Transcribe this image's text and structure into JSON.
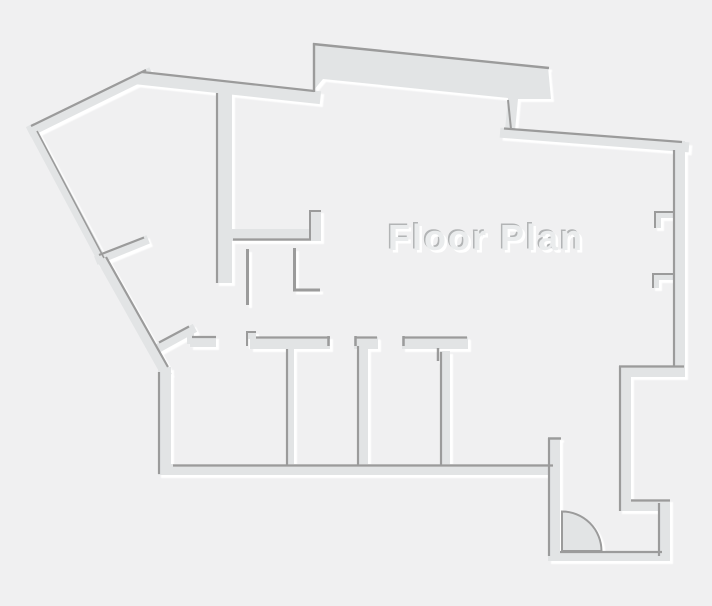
{
  "title": "Floor Plan",
  "canvas": {
    "width": 712,
    "height": 606
  },
  "colors": {
    "background": "#f0f0f1",
    "wall_fill": "#e2e4e5",
    "wall_edge": "#9b9b9b",
    "highlight": "#ffffff",
    "title_fill": "#eaeced",
    "title_shadow_dark": "#b2b4b5",
    "title_shadow_light": "#ffffff"
  },
  "floorplan": {
    "polygon_walls": [
      {
        "name": "top-protrusion-wall",
        "pts": [
          [
            313,
            91
          ],
          [
            314,
            43
          ],
          [
            548,
            67
          ],
          [
            551,
            99
          ],
          [
            518,
            99
          ],
          [
            515,
            131
          ],
          [
            505,
            130
          ],
          [
            508,
            98
          ],
          [
            323,
            79
          ]
        ]
      }
    ],
    "line_walls": [
      {
        "name": "northwest-diagonal-wall",
        "p": [
          33,
          130,
          147,
          74
        ],
        "w": 10
      },
      {
        "name": "west-upper-diagonal-wall",
        "p": [
          32,
          129,
          102,
          260
        ],
        "w": 9
      },
      {
        "name": "southwest-diagonal-wall",
        "p": [
          101,
          258,
          165,
          372
        ],
        "w": 10
      },
      {
        "name": "spur-partition-wall",
        "p": [
          100,
          259,
          144,
          241
        ],
        "w": 9
      },
      {
        "name": "top-wall",
        "p": [
          143,
          78.5,
          314,
          97
        ],
        "w": 13
      },
      {
        "name": "topright-sloped-wall",
        "p": [
          505,
          133,
          684,
          147
        ],
        "w": 10
      },
      {
        "name": "room1-diagonal-stub-wall",
        "p": [
          162,
          346,
          191,
          330
        ],
        "w": 9
      }
    ],
    "rect_walls": [
      {
        "name": "interior-vertical-wall-a",
        "r": [
          216,
          88,
          16,
          195
        ]
      },
      {
        "name": "interior-horizontal-wall-b",
        "r": [
          232,
          229,
          79,
          12
        ]
      },
      {
        "name": "interior-stub-wall-c",
        "r": [
          309,
          210,
          12,
          31
        ]
      },
      {
        "name": "right-outer-wall",
        "r": [
          673,
          141,
          12,
          236
        ]
      },
      {
        "name": "right-wall-jamb1-top",
        "r": [
          654,
          211,
          21,
          7
        ]
      },
      {
        "name": "right-wall-jamb1-side",
        "r": [
          654,
          211,
          7,
          17
        ]
      },
      {
        "name": "right-wall-jamb2-top",
        "r": [
          652,
          273,
          22,
          7
        ]
      },
      {
        "name": "right-wall-jamb2-side",
        "r": [
          652,
          273,
          7,
          15
        ]
      },
      {
        "name": "right-jog-wall",
        "r": [
          619,
          365,
          65,
          12
        ]
      },
      {
        "name": "right-lower-vertical-wall",
        "r": [
          619,
          365,
          12,
          146
        ]
      },
      {
        "name": "entry-step-wall",
        "r": [
          619,
          499,
          51,
          12
        ]
      },
      {
        "name": "entry-right-wall",
        "r": [
          658,
          499,
          12,
          62
        ]
      },
      {
        "name": "entry-bottom-wall",
        "r": [
          548,
          551,
          122,
          10
        ]
      },
      {
        "name": "entry-left-wall",
        "r": [
          548,
          437,
          12,
          124
        ]
      },
      {
        "name": "rooms-bottom-wall",
        "r": [
          158,
          464,
          395,
          11
        ]
      },
      {
        "name": "rooms-left-wall",
        "r": [
          158,
          367,
          13,
          108
        ]
      },
      {
        "name": "room1-top-wall-piece",
        "r": [
          190,
          336,
          26,
          11
        ]
      },
      {
        "name": "room1-top-wall-bridge",
        "r": [
          187,
          329,
          7,
          15
        ]
      },
      {
        "name": "room2-top-wall-piece",
        "r": [
          250,
          337,
          80,
          12
        ]
      },
      {
        "name": "room2-doorjamb-step",
        "r": [
          246,
          331,
          10,
          8
        ]
      },
      {
        "name": "room3-top-wall-piece",
        "r": [
          354,
          337,
          24,
          12
        ]
      },
      {
        "name": "room4-top-wall-piece",
        "r": [
          402,
          337,
          66,
          12
        ]
      },
      {
        "name": "room-divider-wall-1",
        "r": [
          286,
          348,
          8,
          118
        ]
      },
      {
        "name": "room-divider-wall-2",
        "r": [
          357,
          345,
          11,
          121
        ]
      },
      {
        "name": "room-divider-wall-3",
        "r": [
          440,
          351,
          10,
          115
        ]
      }
    ],
    "door": {
      "name": "entry-door-swing",
      "path": "M562,551 L562,511.5 A39.5 39.5 0 0 1 601.5 551 Z"
    },
    "edge_lines": [
      {
        "name": "northwest-wall-edge",
        "p": [
          31,
          126,
          146,
          70
        ],
        "w": 2.2
      },
      {
        "name": "west-upper-wall-edge",
        "p": [
          37,
          131,
          104,
          258
        ],
        "w": 1.6
      },
      {
        "name": "southwest-wall-edge",
        "p": [
          106,
          257,
          168,
          367
        ],
        "w": 2.2
      },
      {
        "name": "spur-wall-edge",
        "p": [
          99,
          255,
          144,
          237.5
        ],
        "w": 2.2
      },
      {
        "name": "top-wall-edge",
        "p": [
          142,
          72,
          314,
          91
        ],
        "w": 2.2
      },
      {
        "name": "protrusion-top-edge",
        "p": [
          313,
          44,
          549,
          68
        ],
        "w": 2.4
      },
      {
        "name": "protrusion-left-edge",
        "p": [
          314,
          43,
          314,
          92
        ],
        "w": 2.4
      },
      {
        "name": "protrusion-neck-edge",
        "p": [
          508,
          100,
          511,
          129
        ],
        "w": 2.0
      },
      {
        "name": "sloped-wall-edge",
        "p": [
          504,
          128.5,
          682,
          142
        ],
        "w": 2.2
      },
      {
        "name": "right-wall-edge",
        "p": [
          674,
          150,
          674,
          366
        ],
        "w": 2.2
      },
      {
        "name": "jamb1-top-edge",
        "p": [
          654,
          212,
          674,
          212
        ],
        "w": 2.0
      },
      {
        "name": "jamb1-side-edge",
        "p": [
          655,
          211,
          655,
          228
        ],
        "w": 2.0
      },
      {
        "name": "jamb2-top-edge",
        "p": [
          652,
          274,
          673,
          274
        ],
        "w": 2.0
      },
      {
        "name": "jamb2-side-edge",
        "p": [
          653,
          273,
          653,
          288
        ],
        "w": 2.0
      },
      {
        "name": "jog-wall-edge",
        "p": [
          619,
          366.5,
          684,
          366.5
        ],
        "w": 2.2
      },
      {
        "name": "lower-vertical-edge",
        "p": [
          620,
          366,
          620,
          511
        ],
        "w": 2.2
      },
      {
        "name": "entry-step-edge",
        "p": [
          631,
          500.5,
          670,
          500.5
        ],
        "w": 2.2
      },
      {
        "name": "entry-right-edge",
        "p": [
          659,
          503,
          659,
          556
        ],
        "w": 2.2
      },
      {
        "name": "entry-bottom-edge",
        "p": [
          560,
          552,
          662,
          552
        ],
        "w": 2.2
      },
      {
        "name": "entry-left-edge",
        "p": [
          549,
          438,
          549,
          556
        ],
        "w": 2.2
      },
      {
        "name": "entry-left-cap-edge",
        "p": [
          548,
          438.5,
          561,
          438.5
        ],
        "w": 2.4
      },
      {
        "name": "rooms-bottom-edge",
        "p": [
          173,
          465.5,
          553,
          465.5
        ],
        "w": 2.2
      },
      {
        "name": "rooms-left-edge",
        "p": [
          159,
          372,
          159,
          474
        ],
        "w": 2.2
      },
      {
        "name": "room1-stub-edge",
        "p": [
          159,
          342.5,
          189,
          326.5
        ],
        "w": 2.2
      },
      {
        "name": "room1-top-edge",
        "p": [
          192,
          337,
          216,
          337
        ],
        "w": 2.2
      },
      {
        "name": "wall-a-edge",
        "p": [
          217,
          93,
          217,
          283
        ],
        "w": 2.2
      },
      {
        "name": "wall-b-edge",
        "p": [
          233,
          239.5,
          311,
          239.5
        ],
        "w": 2.2
      },
      {
        "name": "stub-c-left-edge",
        "p": [
          310,
          210,
          310,
          240
        ],
        "w": 2.0
      },
      {
        "name": "stub-c-top-edge",
        "p": [
          309,
          211,
          321,
          211
        ],
        "w": 2.0
      },
      {
        "name": "thin-partition-1",
        "p": [
          247.5,
          249,
          247.5,
          305
        ],
        "w": 3.0
      },
      {
        "name": "thin-partition-2-vertical",
        "p": [
          294.5,
          248,
          294.5,
          291
        ],
        "w": 3.0
      },
      {
        "name": "thin-partition-2-foot",
        "p": [
          293,
          290,
          320,
          290
        ],
        "w": 3.0
      },
      {
        "name": "room2-top-edge",
        "p": [
          256,
          337.5,
          330,
          337.5
        ],
        "w": 2.2
      },
      {
        "name": "room2-jamb-top-edge",
        "p": [
          246,
          332,
          256,
          332
        ],
        "w": 2.0
      },
      {
        "name": "room2-jamb-left-edge",
        "p": [
          247,
          332,
          247,
          346
        ],
        "w": 2.0
      },
      {
        "name": "room2-right-tick-edge",
        "p": [
          328.5,
          336,
          328.5,
          346
        ],
        "w": 2.5
      },
      {
        "name": "room3-top-edge",
        "p": [
          355,
          337.5,
          377,
          337.5
        ],
        "w": 2.2
      },
      {
        "name": "room3-left-tick-edge",
        "p": [
          355.5,
          336,
          355.5,
          346
        ],
        "w": 2.5
      },
      {
        "name": "room4-top-edge",
        "p": [
          403,
          337.5,
          467,
          337.5
        ],
        "w": 2.2
      },
      {
        "name": "room4-left-tick-edge",
        "p": [
          403.5,
          336,
          403.5,
          346
        ],
        "w": 2.5
      },
      {
        "name": "divider1-edge",
        "p": [
          287,
          349,
          287,
          466
        ],
        "w": 2.2
      },
      {
        "name": "divider2-edge",
        "p": [
          358,
          346,
          358,
          466
        ],
        "w": 2.2
      },
      {
        "name": "divider3-edge",
        "p": [
          441,
          352,
          441,
          466
        ],
        "w": 2.2
      },
      {
        "name": "divider3-tick-edge",
        "p": [
          438,
          348,
          438,
          361
        ],
        "w": 2.5
      }
    ]
  }
}
